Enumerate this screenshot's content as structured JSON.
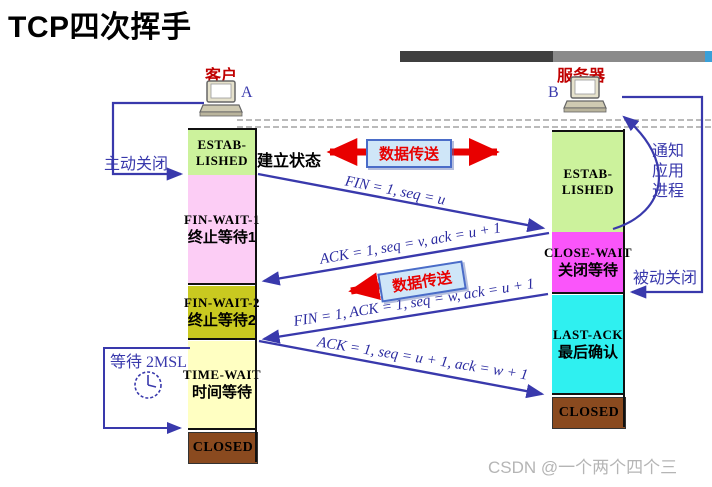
{
  "title": "TCP四次挥手",
  "watermark": "CSDN @一个两个四个三",
  "client": {
    "role": "客户",
    "host": "A",
    "states": [
      {
        "id": "established",
        "lines": [
          "ESTAB-",
          "LISHED"
        ],
        "note": "建立状态",
        "color": "#ccf29c"
      },
      {
        "id": "fin-wait-1",
        "en": "FIN-WAIT-1",
        "zh": "终止等待1",
        "color": "#fccdf5"
      },
      {
        "id": "fin-wait-2",
        "en": "FIN-WAIT-2",
        "zh": "终止等待2",
        "color": "#c9c920"
      },
      {
        "id": "time-wait",
        "en": "TIME-WAIT",
        "zh": "时间等待",
        "color": "#ffffc2"
      },
      {
        "id": "closed",
        "en": "CLOSED",
        "color": "#8a4a1f"
      }
    ]
  },
  "server": {
    "role": "服务器",
    "host": "B",
    "states": [
      {
        "id": "established",
        "lines": [
          "ESTAB-",
          "LISHED"
        ],
        "color": "#ccf29c"
      },
      {
        "id": "close-wait",
        "en": "CLOSE-WAIT",
        "zh": "关闭等待",
        "color": "#fa55fa"
      },
      {
        "id": "last-ack",
        "en": "LAST-ACK",
        "zh": "最后确认",
        "color": "#2ff0f0"
      },
      {
        "id": "closed",
        "en": "CLOSED",
        "color": "#8a4a1f"
      }
    ]
  },
  "messages": [
    {
      "label": "FIN = 1, seq = u",
      "from": "client",
      "to": "server"
    },
    {
      "label": "ACK = 1, seq = v, ack = u + 1",
      "from": "server",
      "to": "client"
    },
    {
      "label": "FIN = 1, ACK = 1, seq = w, ack = u + 1",
      "from": "server",
      "to": "client"
    },
    {
      "label": "ACK = 1, seq = u + 1, ack = w + 1",
      "from": "client",
      "to": "server"
    }
  ],
  "annotations": {
    "active_close": "主动关闭",
    "passive_close": "被动关闭",
    "notify": [
      "通知",
      "应用",
      "进程"
    ],
    "wait_2msl": "等待 2MSL",
    "clock_icon": "clock-icon"
  },
  "data_transfer": {
    "top": "数据传送",
    "bottom": "数据传送"
  },
  "colors": {
    "arrow_blue": "#3939ac",
    "data_arrow_red": "#e80000",
    "role_red": "#c00000",
    "lifeline_black": "#111111",
    "bar_dark_gray": "#3f3f3f",
    "bar_light_gray": "#8a8a8a",
    "bar_blue_tip": "#3aa0d8",
    "watermark_gray": "#b5b5b5"
  }
}
